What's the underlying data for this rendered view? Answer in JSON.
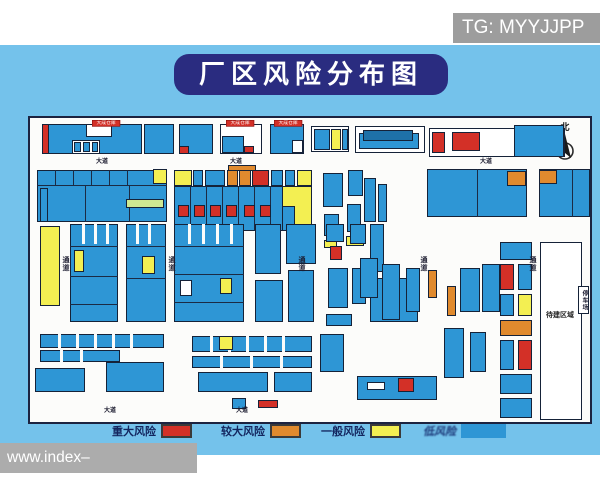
{
  "watermark_top": {
    "text": "TG: MYYJJPP"
  },
  "watermark_bottom": {
    "text": "www.index–365wanmei.com"
  },
  "title": {
    "text": "厂区风险分布图"
  },
  "compass": {
    "label": "北"
  },
  "colors": {
    "background_blue": "#74C2EB",
    "title_bg": "#2A2C80",
    "map_bg": "#FCFCFA",
    "major_risk": "#D33027",
    "larger_risk": "#E08A2E",
    "general_risk": "#F3EF52",
    "low_risk": "#2E96D5"
  },
  "legend": {
    "items": [
      {
        "label": "重大风险",
        "color": "#D33027",
        "left": 112,
        "bordered": true,
        "blur": false
      },
      {
        "label": "较大风险",
        "color": "#E08A2E",
        "left": 221,
        "bordered": true,
        "blur": false
      },
      {
        "label": "一般风险",
        "color": "#F3EF52",
        "left": 321,
        "bordered": true,
        "blur": false
      },
      {
        "label": "低风险",
        "color": "#2E96D5",
        "left": 423,
        "bordered": false,
        "blur": true
      }
    ]
  },
  "map": {
    "colors": {
      "B": "#2E96D5",
      "D": "#1E71A8",
      "R": "#D33027",
      "O": "#E08A2E",
      "Y": "#F3EF52",
      "G": "#CFE992",
      "W": "#FFFFFF",
      "S": "#FCFCFA",
      "L": "#1B2A44"
    },
    "rects": [
      [
        12,
        6,
        100,
        30,
        "B"
      ],
      [
        12,
        6,
        7,
        30,
        "R"
      ],
      [
        56,
        6,
        26,
        13,
        "W"
      ],
      [
        42,
        22,
        28,
        14,
        "W"
      ],
      [
        44,
        24,
        7,
        10,
        "B"
      ],
      [
        53,
        24,
        7,
        10,
        "B"
      ],
      [
        62,
        24,
        6,
        10,
        "B"
      ],
      [
        114,
        6,
        30,
        30,
        "B"
      ],
      [
        149,
        6,
        34,
        30,
        "B"
      ],
      [
        149,
        28,
        10,
        8,
        "R"
      ],
      [
        190,
        6,
        42,
        30,
        "W"
      ],
      [
        192,
        18,
        22,
        17,
        "B"
      ],
      [
        214,
        28,
        10,
        7,
        "R"
      ],
      [
        240,
        6,
        34,
        30,
        "B"
      ],
      [
        262,
        22,
        11,
        13,
        "W"
      ],
      [
        281,
        8,
        38,
        26,
        "W"
      ],
      [
        284,
        11,
        16,
        21,
        "B"
      ],
      [
        301,
        11,
        10,
        21,
        "Y"
      ],
      [
        312,
        11,
        6,
        21,
        "B"
      ],
      [
        325,
        8,
        70,
        27,
        "W"
      ],
      [
        329,
        15,
        60,
        16,
        "B"
      ],
      [
        333,
        12,
        50,
        11,
        "D"
      ],
      [
        399,
        10,
        136,
        29,
        "W"
      ],
      [
        402,
        14,
        13,
        21,
        "R"
      ],
      [
        422,
        14,
        28,
        19,
        "R"
      ],
      [
        484,
        7,
        50,
        32,
        "B"
      ],
      [
        7,
        52,
        130,
        52,
        "B"
      ],
      [
        25,
        52,
        1,
        15,
        "L"
      ],
      [
        43,
        52,
        1,
        15,
        "L"
      ],
      [
        61,
        52,
        1,
        15,
        "L"
      ],
      [
        79,
        52,
        1,
        15,
        "L"
      ],
      [
        97,
        52,
        1,
        15,
        "L"
      ],
      [
        7,
        67,
        130,
        1,
        "L"
      ],
      [
        55,
        67,
        1,
        37,
        "L"
      ],
      [
        99,
        67,
        1,
        37,
        "L"
      ],
      [
        123,
        51,
        14,
        15,
        "Y"
      ],
      [
        96,
        81,
        38,
        9,
        "G"
      ],
      [
        198,
        47,
        28,
        6,
        "O"
      ],
      [
        144,
        52,
        18,
        16,
        "Y"
      ],
      [
        163,
        52,
        10,
        16,
        "B"
      ],
      [
        175,
        52,
        20,
        16,
        "B"
      ],
      [
        197,
        52,
        11,
        16,
        "O"
      ],
      [
        209,
        52,
        12,
        16,
        "O"
      ],
      [
        222,
        52,
        17,
        16,
        "R"
      ],
      [
        241,
        52,
        12,
        16,
        "B"
      ],
      [
        255,
        52,
        10,
        16,
        "B"
      ],
      [
        267,
        52,
        15,
        16,
        "Y"
      ],
      [
        144,
        68,
        120,
        45,
        "B"
      ],
      [
        160,
        68,
        1,
        45,
        "L"
      ],
      [
        176,
        68,
        1,
        45,
        "L"
      ],
      [
        192,
        68,
        1,
        45,
        "L"
      ],
      [
        208,
        68,
        1,
        45,
        "L"
      ],
      [
        224,
        68,
        1,
        45,
        "L"
      ],
      [
        240,
        68,
        1,
        45,
        "L"
      ],
      [
        148,
        87,
        11,
        12,
        "R"
      ],
      [
        164,
        87,
        11,
        12,
        "R"
      ],
      [
        180,
        87,
        11,
        12,
        "R"
      ],
      [
        196,
        87,
        11,
        12,
        "R"
      ],
      [
        214,
        87,
        11,
        12,
        "R"
      ],
      [
        230,
        87,
        11,
        12,
        "R"
      ],
      [
        252,
        68,
        30,
        45,
        "Y"
      ],
      [
        252,
        88,
        13,
        25,
        "B"
      ],
      [
        293,
        55,
        20,
        34,
        "B"
      ],
      [
        318,
        52,
        15,
        26,
        "B"
      ],
      [
        294,
        96,
        15,
        22,
        "B"
      ],
      [
        317,
        86,
        14,
        28,
        "B"
      ],
      [
        294,
        122,
        13,
        8,
        "Y"
      ],
      [
        316,
        118,
        18,
        10,
        "Y"
      ],
      [
        334,
        60,
        12,
        44,
        "B"
      ],
      [
        348,
        66,
        9,
        38,
        "B"
      ],
      [
        397,
        51,
        100,
        48,
        "B"
      ],
      [
        447,
        51,
        1,
        48,
        "L"
      ],
      [
        477,
        53,
        19,
        15,
        "O"
      ],
      [
        509,
        51,
        51,
        48,
        "B"
      ],
      [
        542,
        51,
        1,
        48,
        "L"
      ],
      [
        509,
        52,
        18,
        14,
        "O"
      ],
      [
        10,
        108,
        20,
        80,
        "Y"
      ],
      [
        10,
        70,
        8,
        34,
        "B"
      ],
      [
        40,
        106,
        48,
        98,
        "B"
      ],
      [
        52,
        106,
        3,
        20,
        "S"
      ],
      [
        64,
        106,
        3,
        20,
        "S"
      ],
      [
        76,
        106,
        3,
        20,
        "S"
      ],
      [
        40,
        128,
        48,
        1,
        "L"
      ],
      [
        40,
        158,
        48,
        1,
        "L"
      ],
      [
        40,
        186,
        48,
        1,
        "L"
      ],
      [
        44,
        132,
        10,
        22,
        "Y"
      ],
      [
        96,
        106,
        40,
        98,
        "B"
      ],
      [
        106,
        106,
        3,
        20,
        "S"
      ],
      [
        118,
        106,
        3,
        20,
        "S"
      ],
      [
        96,
        128,
        40,
        1,
        "L"
      ],
      [
        96,
        160,
        40,
        1,
        "L"
      ],
      [
        112,
        138,
        13,
        18,
        "Y"
      ],
      [
        144,
        106,
        70,
        98,
        "B"
      ],
      [
        158,
        106,
        3,
        20,
        "S"
      ],
      [
        172,
        106,
        3,
        20,
        "S"
      ],
      [
        186,
        106,
        3,
        20,
        "S"
      ],
      [
        200,
        106,
        3,
        20,
        "S"
      ],
      [
        144,
        128,
        70,
        1,
        "L"
      ],
      [
        144,
        156,
        70,
        1,
        "L"
      ],
      [
        144,
        184,
        70,
        1,
        "L"
      ],
      [
        150,
        162,
        12,
        16,
        "W"
      ],
      [
        190,
        160,
        12,
        16,
        "Y"
      ],
      [
        225,
        106,
        26,
        50,
        "B"
      ],
      [
        256,
        106,
        30,
        40,
        "B"
      ],
      [
        225,
        162,
        28,
        42,
        "B"
      ],
      [
        258,
        152,
        26,
        52,
        "B"
      ],
      [
        300,
        128,
        12,
        14,
        "R"
      ],
      [
        296,
        106,
        18,
        18,
        "B"
      ],
      [
        320,
        106,
        16,
        20,
        "B"
      ],
      [
        340,
        106,
        14,
        48,
        "B"
      ],
      [
        298,
        150,
        20,
        40,
        "B"
      ],
      [
        322,
        150,
        14,
        36,
        "B"
      ],
      [
        340,
        160,
        48,
        44,
        "B"
      ],
      [
        296,
        196,
        26,
        12,
        "B"
      ],
      [
        330,
        140,
        18,
        40,
        "B"
      ],
      [
        352,
        146,
        18,
        56,
        "B"
      ],
      [
        376,
        150,
        14,
        44,
        "B"
      ],
      [
        398,
        152,
        9,
        28,
        "O"
      ],
      [
        417,
        168,
        9,
        30,
        "O"
      ],
      [
        430,
        150,
        20,
        44,
        "B"
      ],
      [
        452,
        146,
        18,
        48,
        "B"
      ],
      [
        414,
        210,
        20,
        50,
        "B"
      ],
      [
        440,
        214,
        16,
        40,
        "B"
      ],
      [
        470,
        124,
        32,
        18,
        "B"
      ],
      [
        470,
        146,
        14,
        26,
        "R"
      ],
      [
        488,
        146,
        14,
        26,
        "B"
      ],
      [
        470,
        176,
        14,
        22,
        "B"
      ],
      [
        488,
        176,
        14,
        22,
        "Y"
      ],
      [
        470,
        202,
        32,
        16,
        "O"
      ],
      [
        470,
        222,
        14,
        30,
        "B"
      ],
      [
        488,
        222,
        14,
        30,
        "R"
      ],
      [
        470,
        256,
        32,
        20,
        "B"
      ],
      [
        470,
        280,
        32,
        20,
        "B"
      ],
      [
        510,
        124,
        42,
        178,
        "W"
      ],
      [
        548,
        168,
        11,
        28,
        "W"
      ],
      [
        10,
        216,
        124,
        14,
        "B"
      ],
      [
        28,
        216,
        3,
        14,
        "S"
      ],
      [
        46,
        216,
        3,
        14,
        "S"
      ],
      [
        64,
        216,
        3,
        14,
        "S"
      ],
      [
        82,
        216,
        3,
        14,
        "S"
      ],
      [
        100,
        216,
        3,
        14,
        "S"
      ],
      [
        10,
        232,
        80,
        12,
        "B"
      ],
      [
        30,
        232,
        3,
        12,
        "S"
      ],
      [
        50,
        232,
        3,
        12,
        "S"
      ],
      [
        5,
        250,
        50,
        24,
        "B"
      ],
      [
        76,
        244,
        58,
        30,
        "B"
      ],
      [
        162,
        218,
        120,
        16,
        "B"
      ],
      [
        180,
        218,
        3,
        16,
        "S"
      ],
      [
        198,
        218,
        3,
        16,
        "S"
      ],
      [
        216,
        218,
        3,
        16,
        "S"
      ],
      [
        234,
        218,
        3,
        16,
        "S"
      ],
      [
        252,
        218,
        3,
        16,
        "S"
      ],
      [
        189,
        218,
        14,
        14,
        "Y"
      ],
      [
        162,
        238,
        120,
        12,
        "B"
      ],
      [
        190,
        238,
        3,
        12,
        "S"
      ],
      [
        220,
        238,
        3,
        12,
        "S"
      ],
      [
        250,
        238,
        3,
        12,
        "S"
      ],
      [
        168,
        254,
        70,
        20,
        "B"
      ],
      [
        244,
        254,
        38,
        20,
        "B"
      ],
      [
        290,
        216,
        24,
        38,
        "B"
      ],
      [
        327,
        258,
        80,
        24,
        "B"
      ],
      [
        368,
        260,
        16,
        14,
        "R"
      ],
      [
        337,
        264,
        18,
        8,
        "W"
      ],
      [
        202,
        280,
        14,
        11,
        "B"
      ],
      [
        228,
        282,
        20,
        8,
        "R"
      ]
    ],
    "labels": [
      {
        "t": "大道",
        "x": 66,
        "y": 38,
        "o": "h",
        "cls": ""
      },
      {
        "t": "大道",
        "x": 200,
        "y": 38,
        "o": "h",
        "cls": ""
      },
      {
        "t": "大道",
        "x": 450,
        "y": 38,
        "o": "h",
        "cls": ""
      },
      {
        "t": "大道",
        "x": 74,
        "y": 287,
        "o": "h",
        "cls": ""
      },
      {
        "t": "大道",
        "x": 206,
        "y": 287,
        "o": "h",
        "cls": ""
      },
      {
        "t": "通道",
        "x": 30,
        "y": 138,
        "o": "v",
        "cls": ""
      },
      {
        "t": "通道",
        "x": 136,
        "y": 138,
        "o": "v",
        "cls": ""
      },
      {
        "t": "通道",
        "x": 266,
        "y": 138,
        "o": "v",
        "cls": ""
      },
      {
        "t": "通道",
        "x": 388,
        "y": 138,
        "o": "v",
        "cls": ""
      },
      {
        "t": "通道",
        "x": 497,
        "y": 138,
        "o": "v",
        "cls": ""
      },
      {
        "t": "待建区域",
        "x": 516,
        "y": 192,
        "o": "h",
        "cls": "pa"
      },
      {
        "t": "停车场",
        "x": 550,
        "y": 172,
        "o": "v",
        "cls": "sb"
      }
    ],
    "red_tags": [
      {
        "t": "大成仓库",
        "x": 62,
        "y": 2
      },
      {
        "t": "大成仓库",
        "x": 196,
        "y": 2
      },
      {
        "t": "大成仓库",
        "x": 244,
        "y": 2
      }
    ]
  }
}
